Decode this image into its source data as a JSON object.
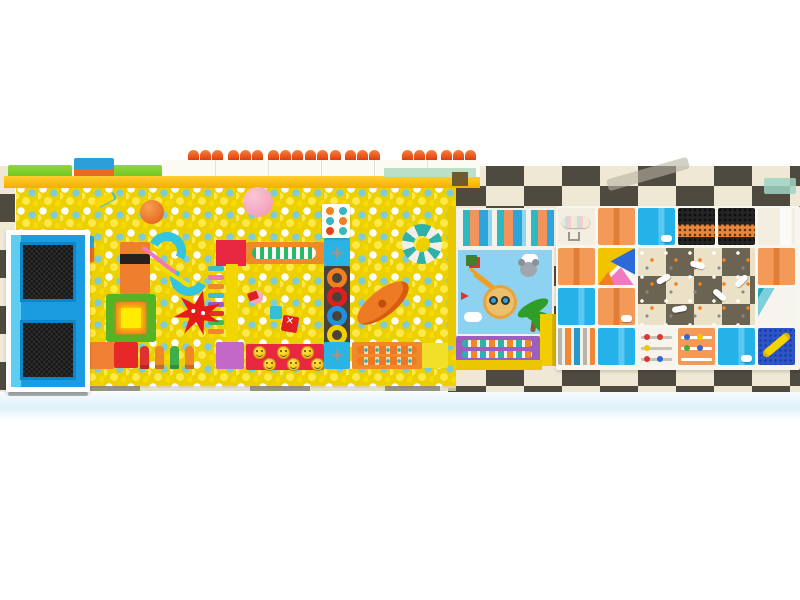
{
  "scene": {
    "type": "indoor-playground-3d-render",
    "view": "top-down",
    "areas": [
      "trampoline-court",
      "yellow-ball-pit",
      "cartoon-mural-zone",
      "soft-play-grid",
      "checkered-floor"
    ]
  },
  "colors": {
    "ball-base": "#ecd000",
    "ball-a": "#ffffff",
    "ball-b": "#7ecdd6",
    "ball-c": "#ffe94a",
    "ball-d": "#f6da00",
    "checker-dark": "#4f4a40",
    "checker-light": "#efe8d5",
    "dome-a": "#f8833a",
    "dome-b": "#e03c10",
    "ledge": "#f3b000",
    "grass": "#70c51d",
    "mint": "#bcdfc8",
    "wall": "#fbfaf3",
    "tramp-pad": "#1b9be0",
    "cell-orange": "#f39a58",
    "cell-blue": "#25b2e8",
    "cream": "#f3eee0",
    "mesh-dark": "#242424",
    "mesh-orange": "#e8863c",
    "confetti-a": "#ebe1c6",
    "confetti-b": "#6b6452",
    "zig-a": "#1fa8bc",
    "zig-b": "#7cd0dc",
    "peg": "#2d55c8",
    "tube": "#f2d500",
    "purple": "#9c5fc0",
    "sky": "#8dd2f0",
    "red-block": "#e82840",
    "orange-plat": "#f08a28",
    "cyan-block": "#2ab4e4",
    "yellow-beam": "#f2d600",
    "ring-beam": "#4a4239",
    "purple-block": "#c468c8",
    "green-plat": "#55b426",
    "glow": "#ffec00",
    "star-red": "#e51a1a",
    "boat": "#ef7a24",
    "slide": "#35c4de",
    "ring-teal": "#2fb0a8",
    "mural-green": "#2f9e28",
    "lion": "#ecbf6a",
    "koala": "#a0a6ae",
    "ladder": "#f0a020",
    "floor-tint": "#ddf1f8"
  },
  "top_wall": {
    "dome_xs": [
      188,
      200,
      212,
      228,
      240,
      252,
      268,
      280,
      292,
      305,
      317,
      330,
      345,
      357,
      369,
      402,
      414,
      426,
      441,
      453,
      465
    ]
  },
  "play_items": {
    "ring_colors": [
      "#f08020",
      "#e02020",
      "#2090e0",
      "#f2d000"
    ],
    "ladder_rung_colors": [
      "#38c0d0",
      "#f078b0",
      "#f08828",
      "#38c0d0",
      "#9858c8",
      "#e03030",
      "#48b848",
      "#f08828"
    ],
    "pillar_colors": [
      "#e03030",
      "#f08828",
      "#3fae4a",
      "#f08828"
    ],
    "smiley_roller_count": 6,
    "dot_panel_rows": [
      [
        "#f08020",
        "#38b4c4"
      ],
      [
        "#38b4c4",
        "#f08020"
      ],
      [
        "#e8401c",
        "#38b4c4"
      ]
    ],
    "trampoline_mat_count": 2
  },
  "structure": {
    "tangram_colors": [
      "#f2c400",
      "#2b6ad8",
      "#f07ac0",
      "#f08020"
    ],
    "beads_white_dots": [
      [
        "#e03434",
        "#e03434"
      ],
      [
        "#f2c400"
      ],
      [
        "#e03434",
        "#2b6ad8"
      ]
    ],
    "beads_orange_dots": [
      [
        "#2b6ad8",
        "#f2c400"
      ],
      [
        "#3fae4a",
        "#2b6ad8"
      ]
    ],
    "confetti_planes": [
      [
        18,
        28,
        -30
      ],
      [
        52,
        14,
        15
      ],
      [
        74,
        44,
        40
      ],
      [
        34,
        58,
        -10
      ],
      [
        96,
        30,
        -45
      ]
    ],
    "cells": [
      {
        "r": 0,
        "c": 0,
        "type": "roller"
      },
      {
        "r": 0,
        "c": 1,
        "type": "orange"
      },
      {
        "r": 0,
        "c": 2,
        "type": "blue",
        "deco": "roll"
      },
      {
        "r": 0,
        "c": 3,
        "type": "mesh"
      },
      {
        "r": 0,
        "c": 4,
        "type": "mesh"
      },
      {
        "r": 0,
        "c": 5,
        "type": "cream"
      },
      {
        "r": 1,
        "c": 0,
        "type": "orange"
      },
      {
        "r": 1,
        "c": 1,
        "type": "tangram"
      },
      {
        "r": 1,
        "c": 2,
        "w": 3,
        "h": 2,
        "type": "confetti"
      },
      {
        "r": 1,
        "c": 5,
        "type": "orange"
      },
      {
        "r": 2,
        "c": 0,
        "type": "blue"
      },
      {
        "r": 2,
        "c": 1,
        "type": "orange",
        "deco": "roll"
      },
      {
        "r": 2,
        "c": 5,
        "type": "zigzag"
      },
      {
        "r": 3,
        "c": 0,
        "type": "stripes"
      },
      {
        "r": 3,
        "c": 1,
        "type": "blue"
      },
      {
        "r": 3,
        "c": 2,
        "type": "beads",
        "dots": "beads_white_dots"
      },
      {
        "r": 3,
        "c": 3,
        "type": "beads-orange",
        "dots": "beads_orange_dots"
      },
      {
        "r": 3,
        "c": 4,
        "type": "blue",
        "deco": "roll"
      },
      {
        "r": 3,
        "c": 5,
        "type": "pegboard"
      }
    ]
  }
}
